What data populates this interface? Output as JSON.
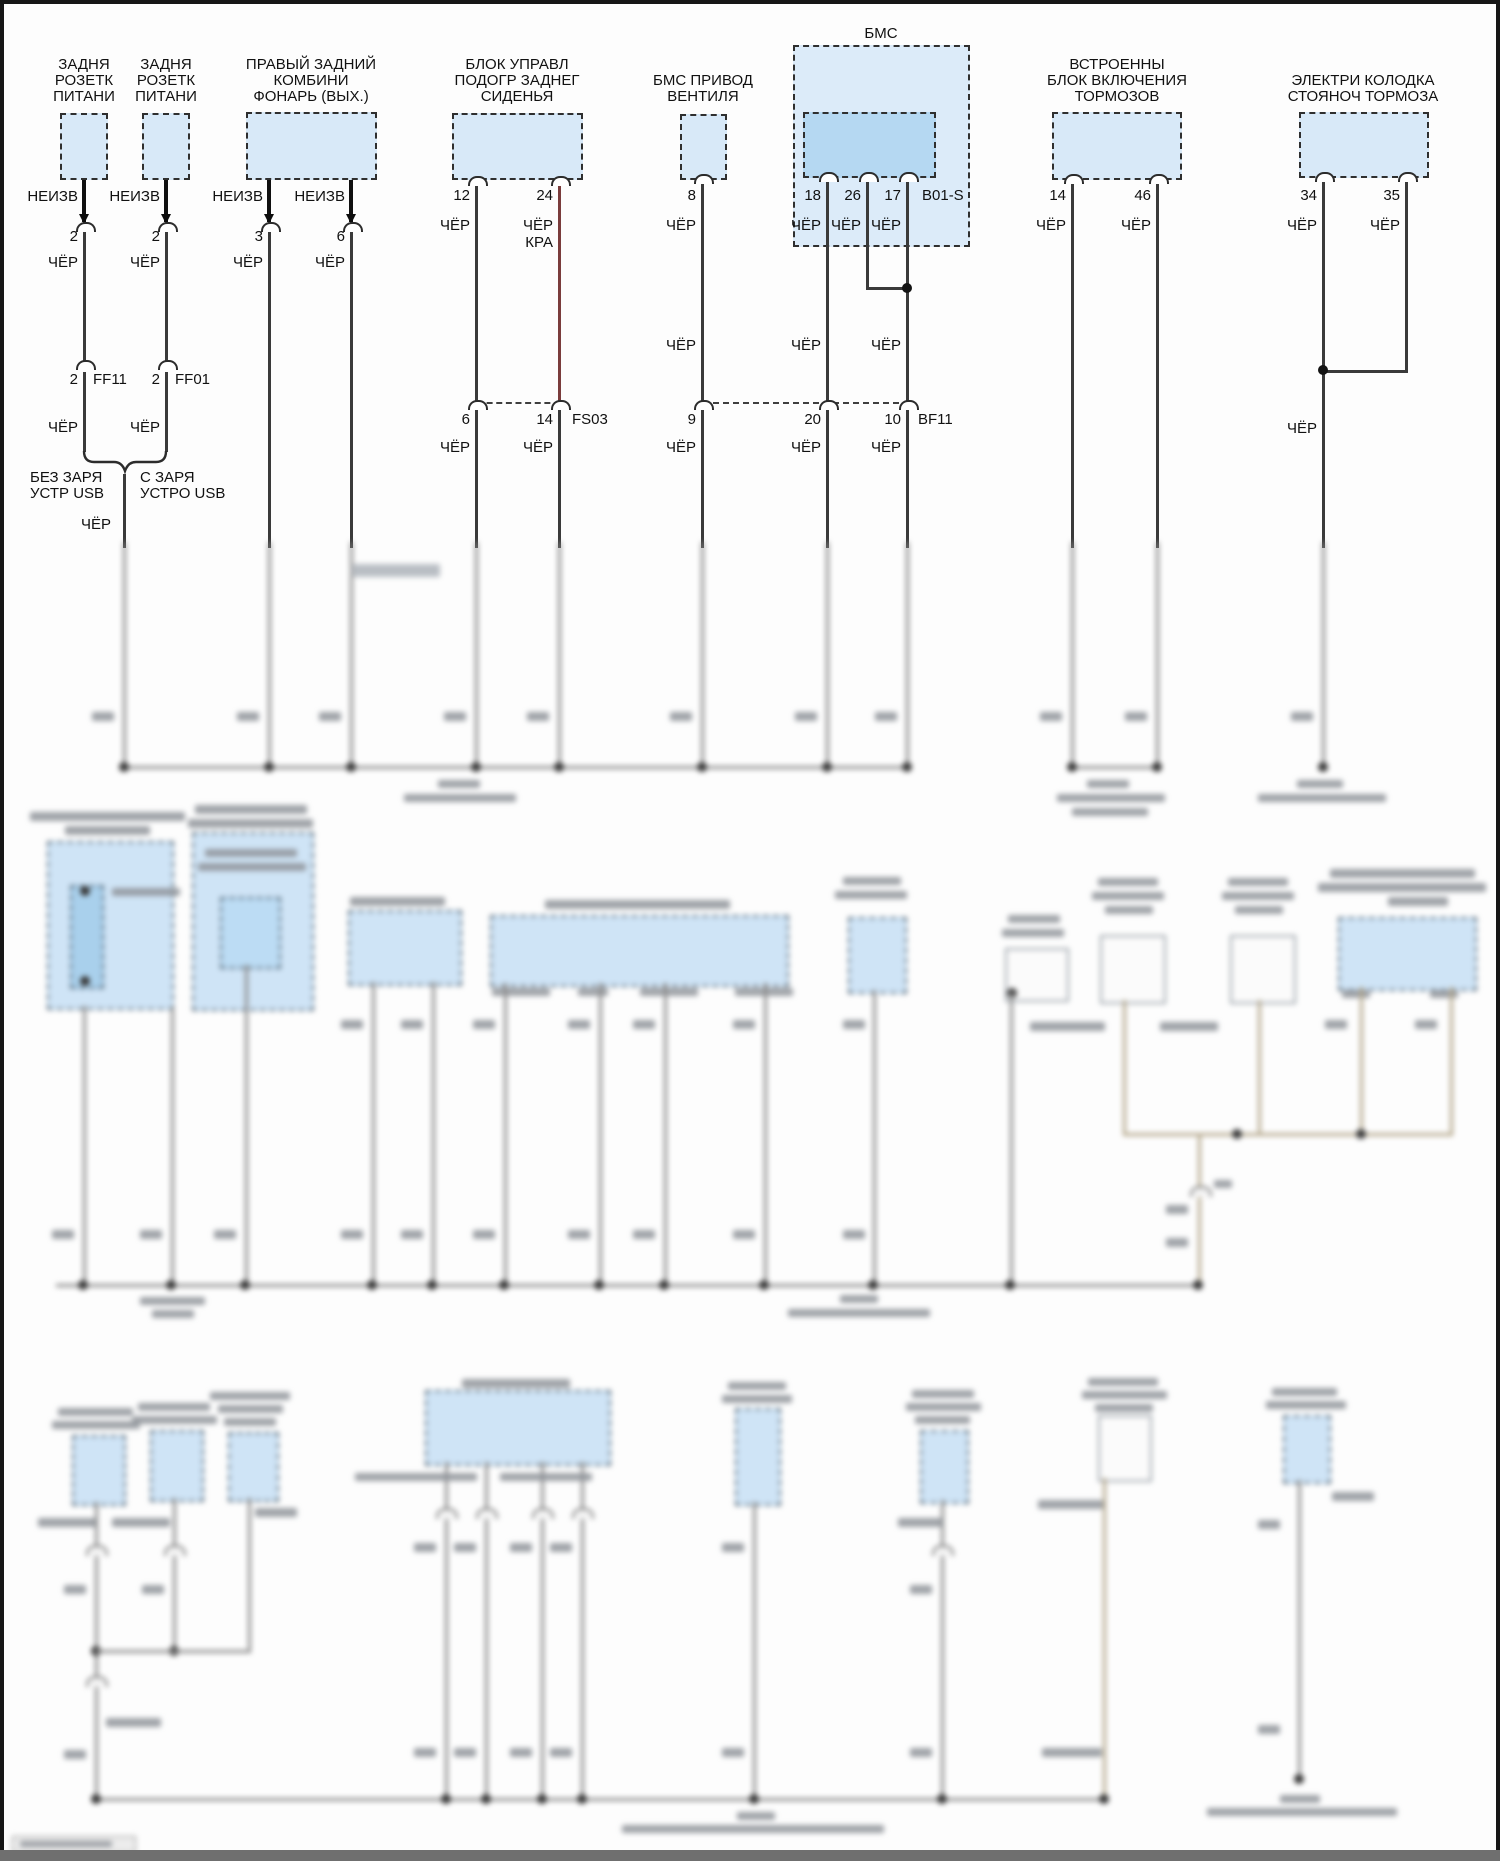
{
  "diagram_type": "automotive wiring diagram (ground distribution)",
  "colors": {
    "component_fill": "#d8e9f8",
    "inner_module_fill": "#b5d8f2",
    "wire_black": "#3a3a3a",
    "wire_dark_red": "#7a3c3c",
    "blurred_wire_beige": "#b3a68a",
    "page_border": "#161616"
  },
  "components": {
    "rear_socket_1": {
      "l1": "ЗАДНЯ",
      "l2": "РОЗЕТК",
      "l3": "ПИТАНИ"
    },
    "rear_socket_2": {
      "l1": "ЗАДНЯ",
      "l2": "РОЗЕТК",
      "l3": "ПИТАНИ"
    },
    "right_rear_lamp": {
      "l1": "ПРАВЫЙ ЗАДНИЙ",
      "l2": "КОМБИНИ",
      "l3": "ФОНАРЬ (ВЫХ.)"
    },
    "seat_heater_module": {
      "l1": "БЛОК УПРАВЛ",
      "l2": "ПОДОГР ЗАДНЕГ",
      "l3": "СИДЕНЬЯ"
    },
    "bms_fan_drive": {
      "l1": "БМС ПРИВОД",
      "l2": "ВЕНТИЛЯ"
    },
    "bms_group": "БМС",
    "bms_control_unit": {
      "l1": "БЛОК",
      "l2": "УПРАВЛЕНИЯ",
      "l3": "BMS"
    },
    "integrated_brake_unit": {
      "l1": "ВСТРОЕННЫ",
      "l2": "БЛОК ВКЛЮЧЕНИЯ",
      "l3": "ТОРМОЗОВ"
    },
    "parking_brake_connector": {
      "l1": "ЭЛЕКТРИ КОЛОДКА",
      "l2": "СТОЯНОЧ ТОРМОЗА"
    }
  },
  "wire_labels": {
    "unknown": "НЕИЗВ",
    "black": "ЧЁР",
    "red": "КРА"
  },
  "connectors": {
    "ff11": "FF11",
    "ff01": "FF01",
    "fs03": "FS03",
    "bf11": "BF11",
    "b01_s": "B01-S"
  },
  "pins": {
    "p2": "2",
    "p3": "3",
    "p6": "6",
    "p8": "8",
    "p9": "9",
    "p10": "10",
    "p12": "12",
    "p14": "14",
    "p17": "17",
    "p18": "18",
    "p20": "20",
    "p24": "24",
    "p26": "26",
    "p34": "34",
    "p35": "35",
    "p46": "46"
  },
  "variants": {
    "without_usb_l1": "БЕЗ ЗАРЯ",
    "without_usb_l2": "УСТР USB",
    "with_usb_l1": "С ЗАРЯ",
    "with_usb_l2": "УСТРО USB"
  }
}
